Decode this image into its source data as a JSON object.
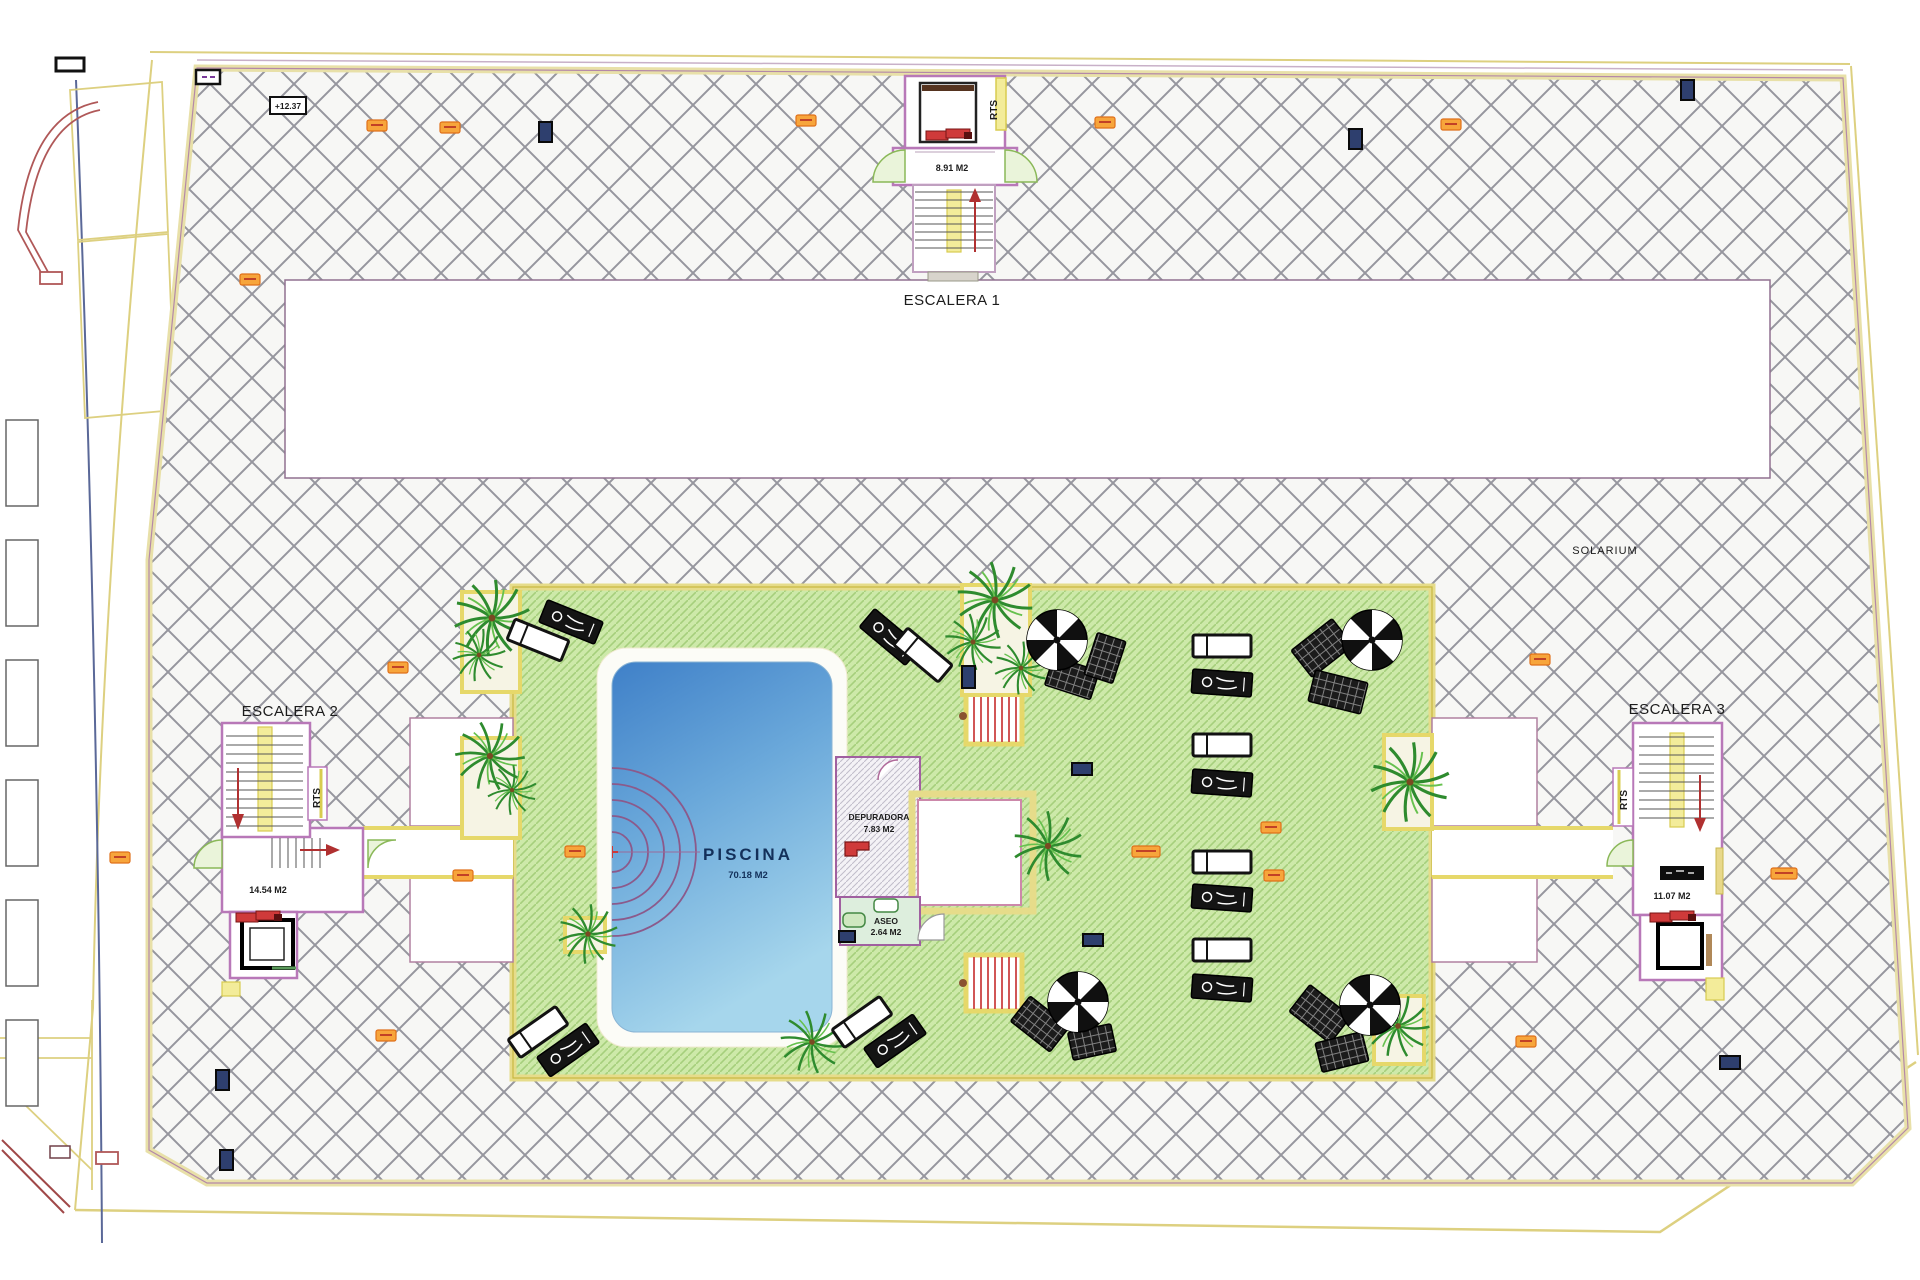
{
  "plan": {
    "type": "roof-terrace floor plan",
    "escalera1": {
      "name": "ESCALERA 1",
      "area": "8.91 M2",
      "rts": "RTS"
    },
    "escalera2": {
      "name": "ESCALERA 2",
      "area": "14.54 M2",
      "rts": "RTS"
    },
    "escalera3": {
      "name": "ESCALERA 3",
      "area": "11.07 M2",
      "rts": "RTS"
    },
    "solarium_label": "SOLARIUM",
    "pool": {
      "name": "PISCINA",
      "area": "70.18 M2"
    },
    "depuradora": {
      "name": "DEPURADORA",
      "area": "7.83 M2"
    },
    "aseo": {
      "name": "ASEO",
      "area": "2.64 M2"
    },
    "level_marker": "+12.37"
  },
  "colors": {
    "terrace_hatch_line": "#96969e",
    "deck_green": "#cde9a9",
    "deck_hatch_line": "#a6cf7c",
    "pool_blue_dark": "#3f80c8",
    "pool_blue_light": "#a6d6ec",
    "wall_pink": "#b878b8",
    "band_yellow": "#e8df95",
    "accent_red": "#cc3a3a",
    "door_green": "#8ab858",
    "tag_orange": "#f7a53b",
    "tag_blue": "#2e3f6e"
  }
}
